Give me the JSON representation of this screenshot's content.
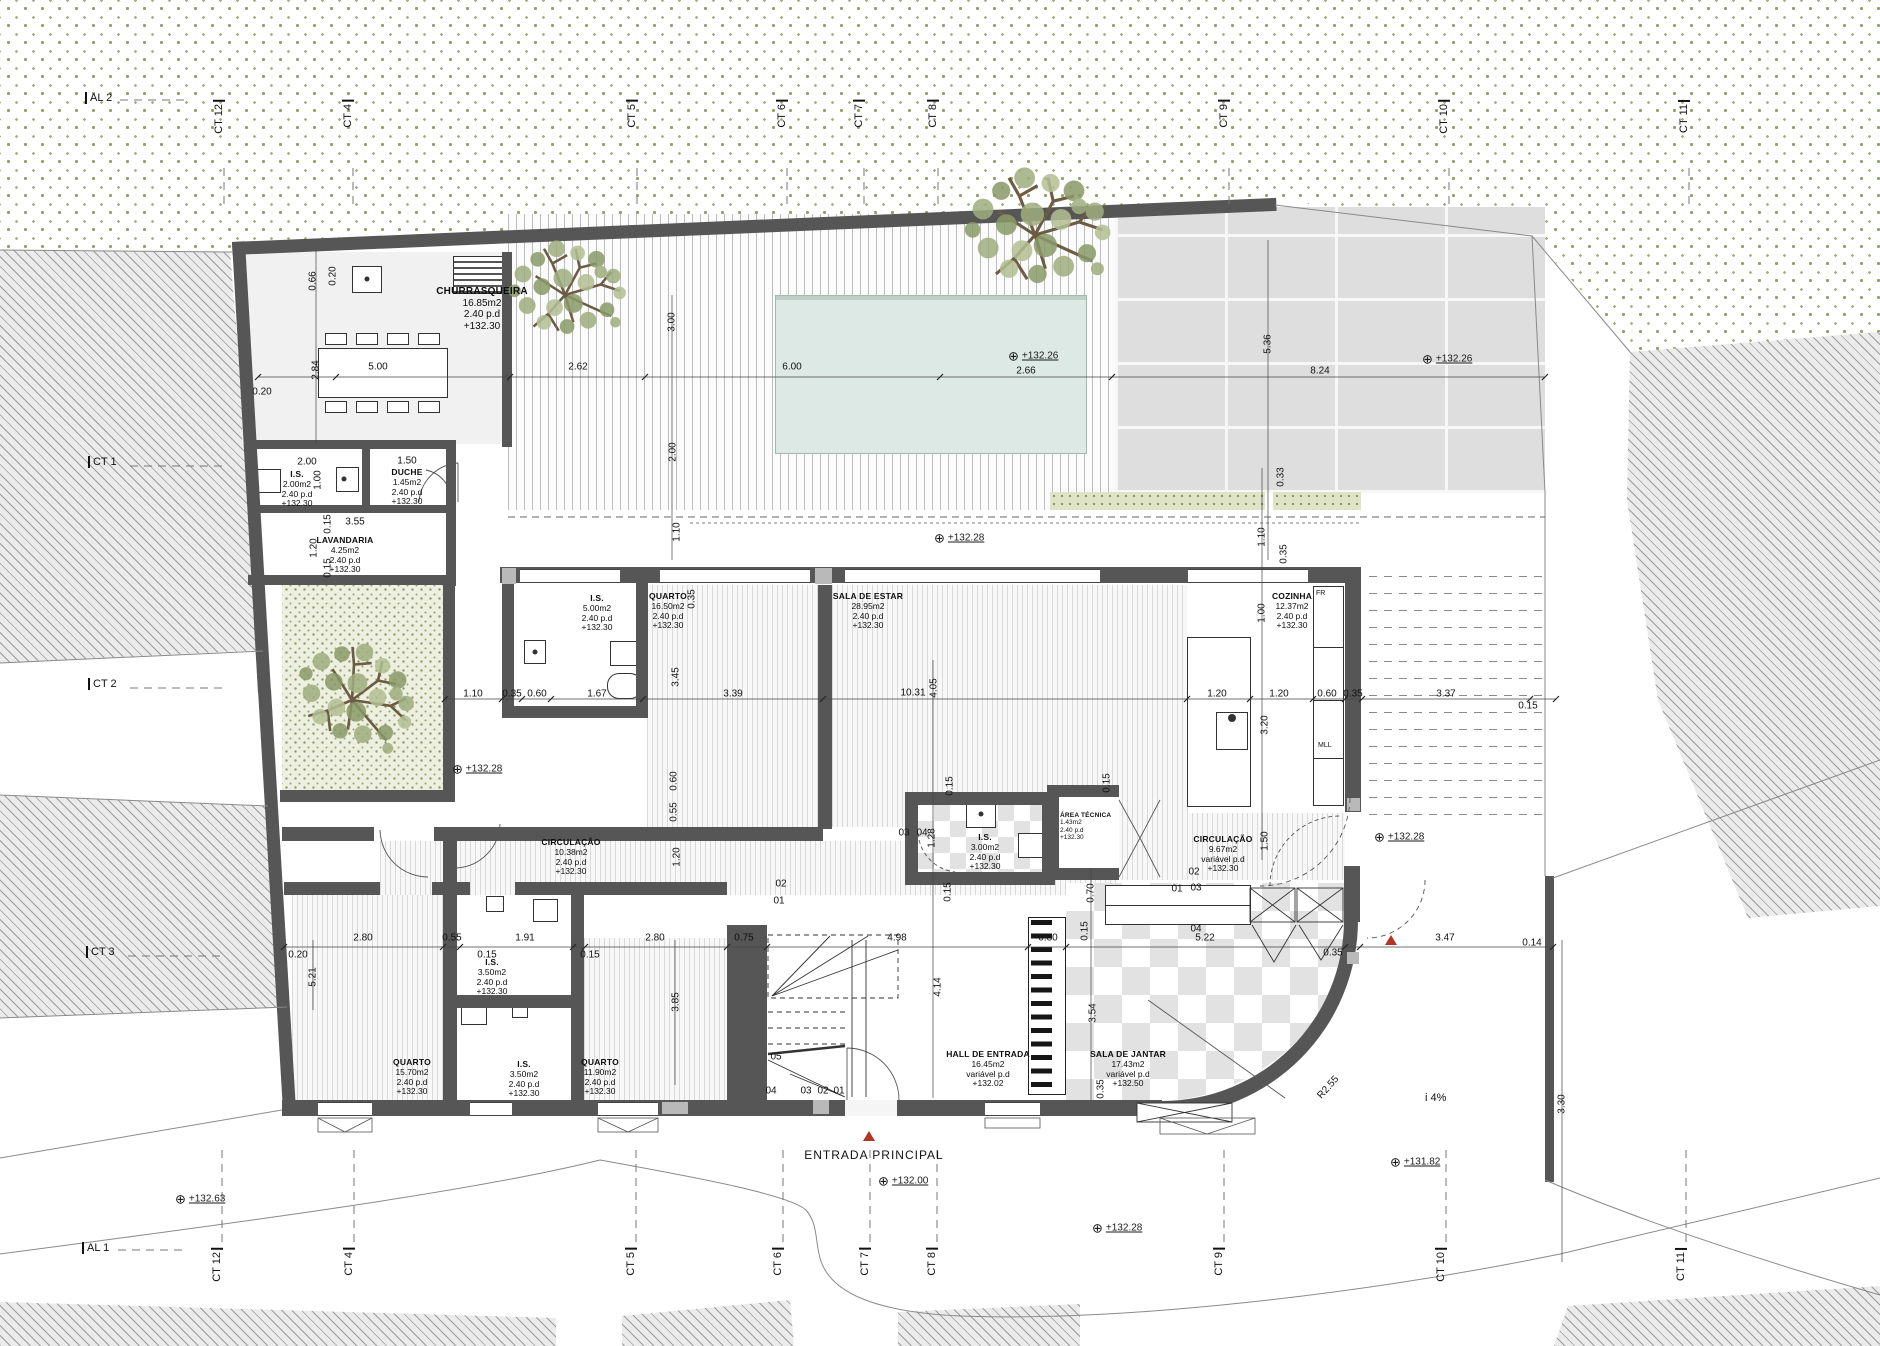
{
  "grid": {
    "top": [
      "AL 2",
      "CT 12",
      "CT 4",
      "CT 5",
      "CT 6",
      "CT 7",
      "CT 8",
      "CT 9",
      "CT 10",
      "CT 11"
    ],
    "bottom": [
      "AL 1",
      "CT 12",
      "CT 4",
      "CT 5",
      "CT 6",
      "CT 7",
      "CT 8",
      "CT 9",
      "CT 10",
      "CT 11"
    ],
    "left": [
      "CT 1",
      "CT 2",
      "CT 3"
    ]
  },
  "rooms": [
    {
      "name": "CHURRASQUEIRA",
      "area": "16.85m2",
      "pd": "2.40  p.d",
      "level": "+132.30"
    },
    {
      "name": "I.S.",
      "area": "2.00m2",
      "pd": "2.40  p.d",
      "level": "+132.30"
    },
    {
      "name": "DUCHE",
      "area": "1.45m2",
      "pd": "2.40  p.d",
      "level": "+132.30"
    },
    {
      "name": "LAVANDARIA",
      "area": "4.25m2",
      "pd": "2.40  p.d",
      "level": "+132.30"
    },
    {
      "name": "I.S.",
      "area": "5.00m2",
      "pd": "2.40  p.d",
      "level": "+132.30"
    },
    {
      "name": "QUARTO",
      "area": "16.50m2",
      "pd": "2.40  p.d",
      "level": "+132.30"
    },
    {
      "name": "SALA DE ESTAR",
      "area": "28.95m2",
      "pd": "2.40  p.d",
      "level": "+132.30"
    },
    {
      "name": "COZINHA",
      "area": "12.37m2",
      "pd": "2.40  p.d",
      "level": "+132.30"
    },
    {
      "name": "CIRCULAÇÃO",
      "area": "10.38m2",
      "pd": "2.40  p.d",
      "level": "+132.30"
    },
    {
      "name": "I.S.",
      "area": "3.00m2",
      "pd": "2.40  p.d",
      "level": "+132.30"
    },
    {
      "name": "ÁREA TÉCNICA",
      "area": "1.43m2",
      "pd": "2.40  p.d",
      "level": "+132.30"
    },
    {
      "name": "CIRCULAÇÃO",
      "area": "9.67m2",
      "pd": "variável  p.d",
      "level": "+132.30"
    },
    {
      "name": "QUARTO",
      "area": "15.70m2",
      "pd": "2.40  p.d",
      "level": "+132.30"
    },
    {
      "name": "I.S.",
      "area": "3.50m2",
      "pd": "2.40  p.d",
      "level": "+132.30"
    },
    {
      "name": "I.S.",
      "area": "3.50m2",
      "pd": "2.40  p.d",
      "level": "+132.30"
    },
    {
      "name": "QUARTO",
      "area": "11.90m2",
      "pd": "2.40  p.d",
      "level": "+132.30"
    },
    {
      "name": "HALL DE ENTRADA",
      "area": "16.45m2",
      "pd": "variável  p.d",
      "level": "+132.02"
    },
    {
      "name": "SALA DE JANTAR",
      "area": "17.43m2",
      "pd": "variável  p.d",
      "level": "+132.50"
    }
  ],
  "levels": [
    "+132.26",
    "+132.26",
    "+132.28",
    "+132.28",
    "+132.28",
    "+132.28",
    "+132.00",
    "+131.82",
    "+132.63"
  ],
  "dims": [
    "0.20",
    "0.66",
    "2.84",
    "5.00",
    "2.62",
    "6.00",
    "2.66",
    "8.24",
    "0.20",
    "3.00",
    "2.00",
    "5.36",
    "0.33",
    "1.10",
    "0.35",
    "1.10",
    "2.00",
    "1.00",
    "1.50",
    "3.55",
    "0.15",
    "1.20",
    "0.15",
    "1.10",
    "0.35",
    "0.60",
    "1.67",
    "3.39",
    "0.35",
    "3.45",
    "10.31",
    "4.05",
    "1.20",
    "1.20",
    "0.60",
    "0.35",
    "3.37",
    "0.15",
    "1.00",
    "3.20",
    "1.50",
    "0.15",
    "1.28",
    "0.15",
    "0.60",
    "0.55",
    "1.20",
    "2.80",
    "0.55",
    "1.91",
    "0.15",
    "0.15",
    "0.20",
    "5.21",
    "2.80",
    "0.75",
    "3.85",
    "4.98",
    "4.14",
    "0.80",
    "5.22",
    "0.15",
    "0.70",
    "0.15",
    "3.54",
    "0.35",
    "0.35",
    "3.47",
    "0.14",
    "3.30"
  ],
  "annotations": {
    "entrada": "ENTRADA  PRINCIPAL",
    "ramp": "i  4%",
    "radius": "R2.55",
    "fr": "FR",
    "mll": "MLL",
    "n01": "01",
    "n02": "02",
    "n03": "03",
    "n04": "04",
    "n05": "05"
  },
  "colors": {
    "wall": "#565656",
    "pool": "#dde9e4",
    "vegetation": "#93a06c",
    "hatch": "#9c9c9c",
    "entrance_marker": "#b03522",
    "stone": "#dedede"
  }
}
